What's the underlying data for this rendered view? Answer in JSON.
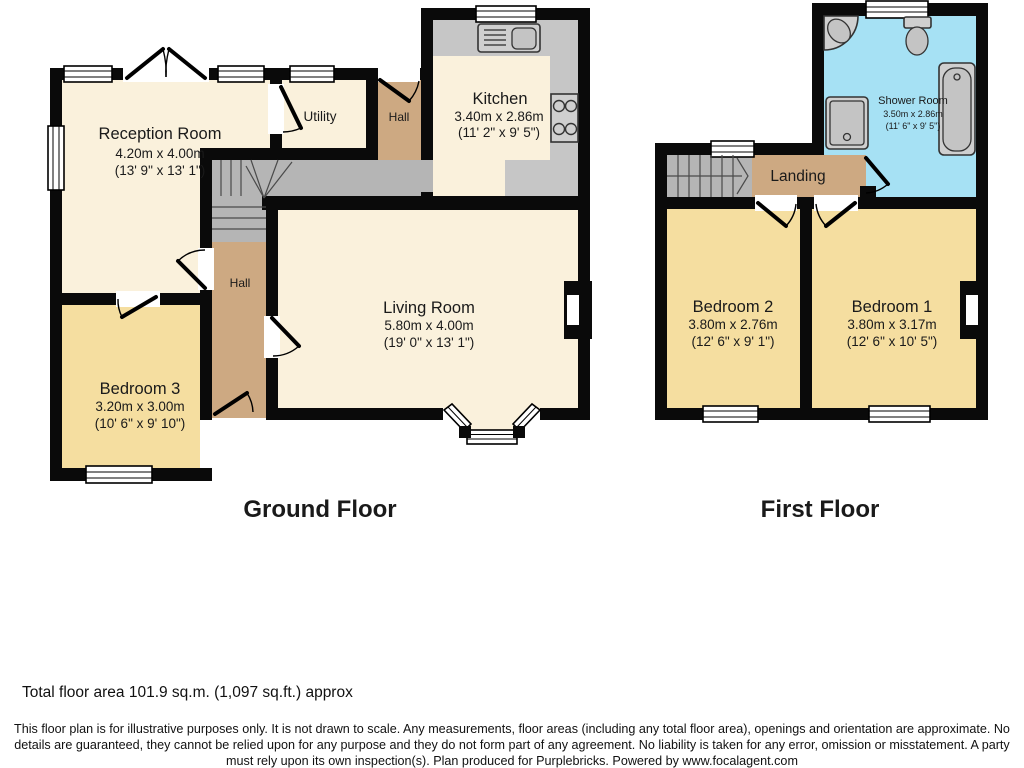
{
  "ground": {
    "title": "Ground Floor",
    "reception": {
      "name": "Reception Room",
      "metric": "4.20m x 4.00m",
      "imperial": "(13' 9\" x 13' 1\")"
    },
    "utility": {
      "name": "Utility"
    },
    "hall_top": {
      "name": "Hall"
    },
    "hall_mid": {
      "name": "Hall"
    },
    "kitchen": {
      "name": "Kitchen",
      "metric": "3.40m x 2.86m",
      "imperial": "(11' 2\" x 9' 5\")"
    },
    "living": {
      "name": "Living Room",
      "metric": "5.80m x 4.00m",
      "imperial": "(19' 0\" x 13' 1\")"
    },
    "bedroom3": {
      "name": "Bedroom 3",
      "metric": "3.20m x 3.00m",
      "imperial": "(10' 6\" x 9' 10\")"
    }
  },
  "first": {
    "title": "First Floor",
    "shower": {
      "name": "Shower Room",
      "metric": "3.50m x 2.86m",
      "imperial": "(11' 6\" x 9' 5\")"
    },
    "landing": {
      "name": "Landing"
    },
    "bedroom2": {
      "name": "Bedroom 2",
      "metric": "3.80m x 2.76m",
      "imperial": "(12' 6\" x 9' 1\")"
    },
    "bedroom1": {
      "name": "Bedroom 1",
      "metric": "3.80m x 3.17m",
      "imperial": "(12' 6\" x 10' 5\")"
    }
  },
  "footer": {
    "total_area": "Total floor area 101.9 sq.m. (1,097 sq.ft.) approx",
    "disclaimer": "This floor plan is for illustrative purposes only. It is not drawn to scale. Any measurements, floor areas (including any total floor area), openings and orientation are approximate. No details are guaranteed, they cannot be relied upon for any purpose and they do not form part of any agreement. No liability is taken for any error, omission or misstatement. A party must rely upon its own inspection(s). Plan produced for Purplebricks. Powered by www.focalagent.com"
  },
  "colors": {
    "cream": "#FAF1DC",
    "yellow": "#F5DEA0",
    "tan": "#CDA982",
    "blue": "#A6E1F4",
    "gray": "#B5B5B5",
    "counter": "#C6C6C6",
    "wall": "#0a0a0a"
  }
}
